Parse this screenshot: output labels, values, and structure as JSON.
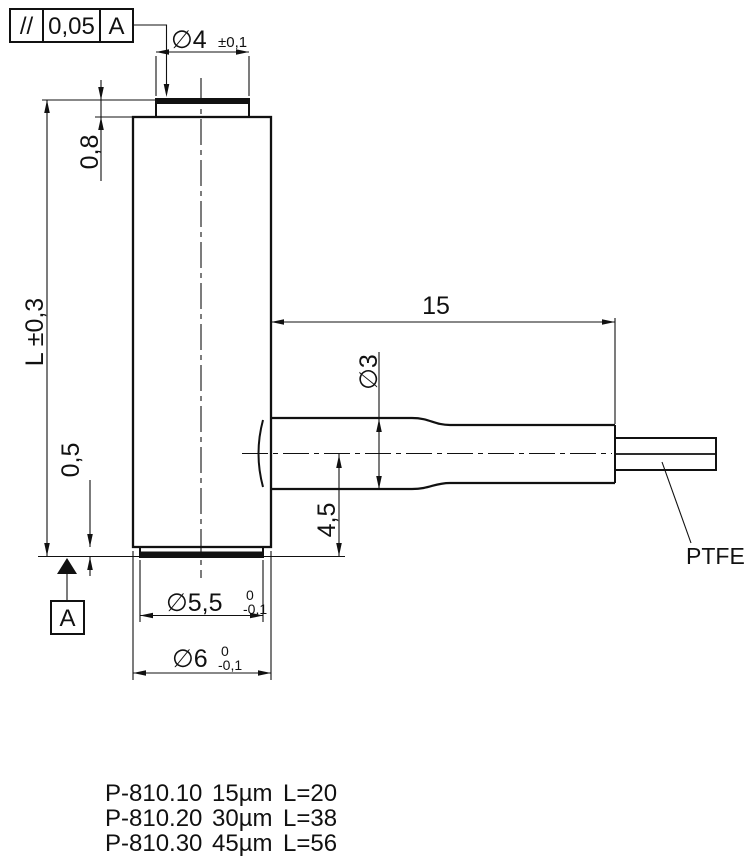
{
  "frame": {
    "symbol": "//",
    "tolerance": "0,05",
    "datum": "A"
  },
  "dimensions": {
    "top_diameter": "∅4",
    "top_diameter_tol": "±0,1",
    "top_cap_thickness": "0,8",
    "length": "L ±0,3",
    "bottom_cap_thickness": "0,5",
    "bottom_cap_diameter": "∅5,5",
    "bottom_cap_diameter_tol_upper": "0",
    "bottom_cap_diameter_tol_lower": "-0,1",
    "body_diameter": "∅6",
    "body_diameter_tol_upper": "0",
    "body_diameter_tol_lower": "-0,1",
    "sleeve_length": "15",
    "sleeve_diameter": "∅3",
    "cable_center_offset": "4,5",
    "datum_label": "A",
    "cable_material": "PTFE"
  },
  "model_table": {
    "rows": [
      {
        "model": "P-810.10",
        "stroke": "15µm",
        "length": "L=20"
      },
      {
        "model": "P-810.20",
        "stroke": "30µm",
        "length": "L=38"
      },
      {
        "model": "P-810.30",
        "stroke": "45µm",
        "length": "L=56"
      }
    ]
  },
  "colors": {
    "line": "#111111",
    "background": "#ffffff"
  }
}
